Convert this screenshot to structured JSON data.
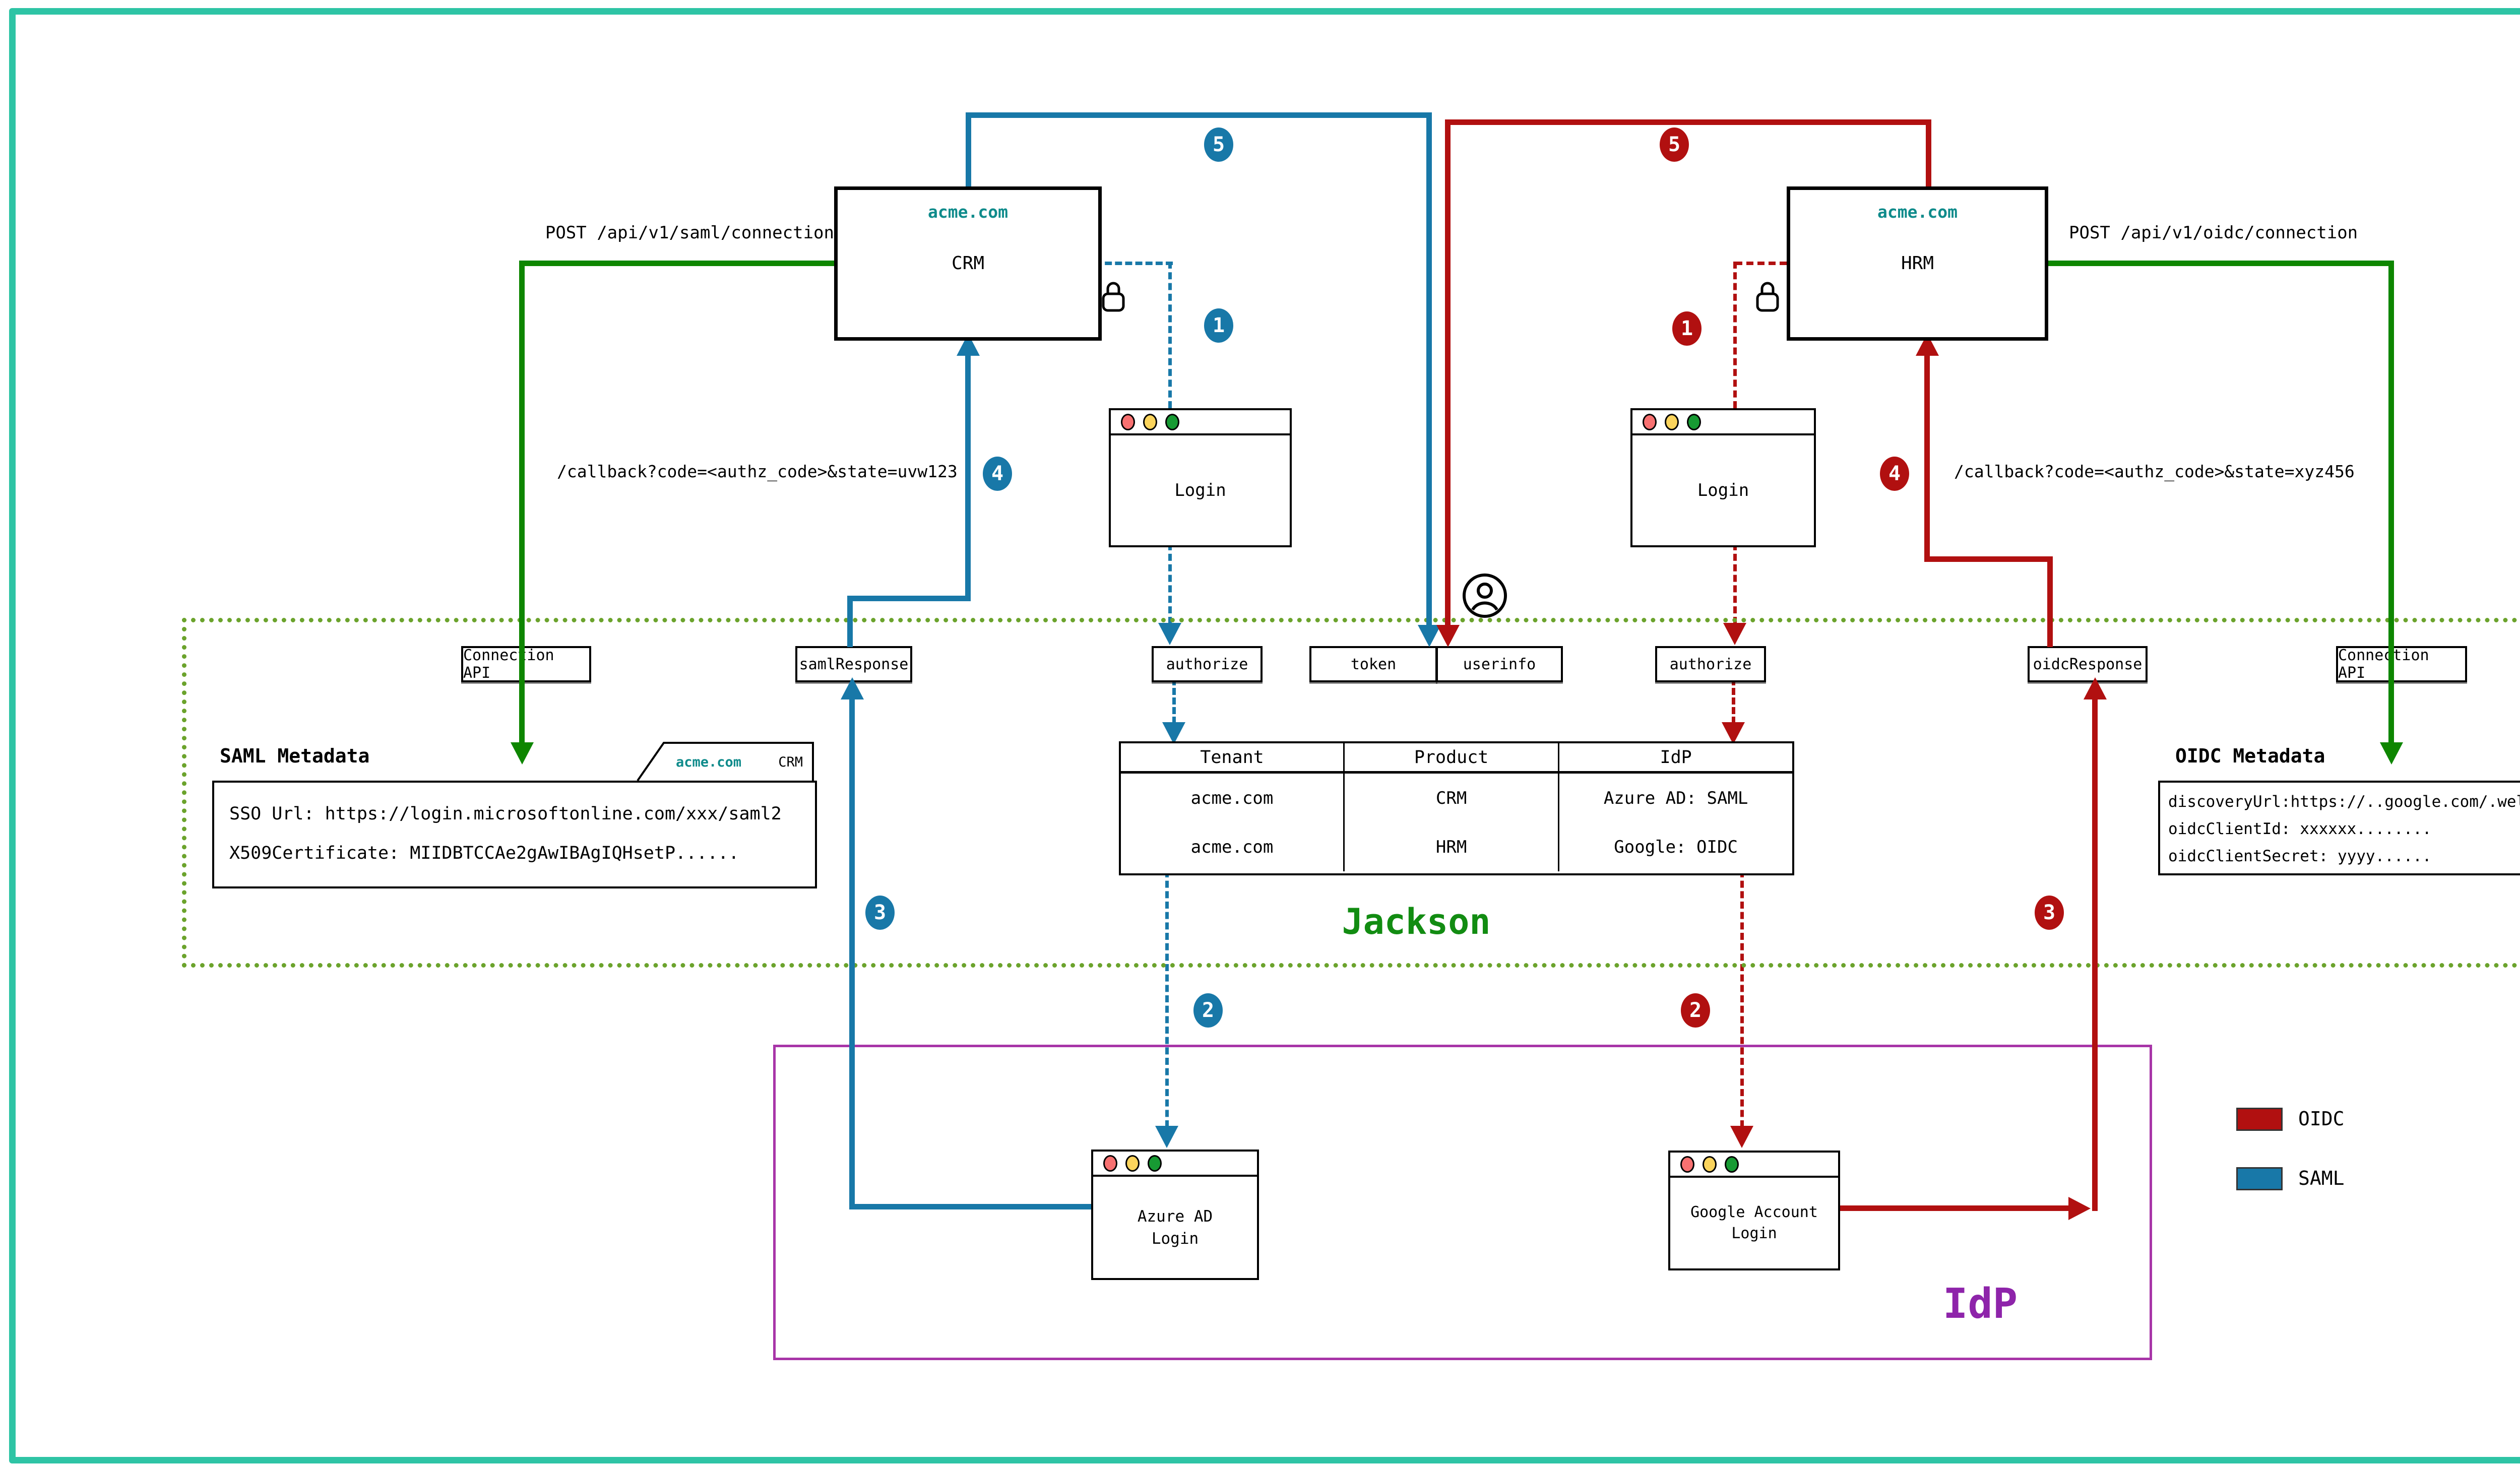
{
  "colors": {
    "saml_blue": "#1878a8",
    "oidc_red": "#b11010",
    "connection_green": "#0e8600",
    "jackson_green": "#128c12",
    "jackson_border_olive": "#6ba32c",
    "idp_purple": "#8e24aa",
    "domain_teal": "#0f8b8b",
    "frame_teal": "#2ec4a5"
  },
  "apps": {
    "crm": {
      "domain": "acme.com",
      "name": "CRM"
    },
    "hrm": {
      "domain": "acme.com",
      "name": "HRM"
    }
  },
  "flows": {
    "post_saml": "POST /api/v1/saml/connection",
    "post_oidc": "POST /api/v1/oidc/connection",
    "callback_saml": "/callback?code=<authz_code>&state=uvw123",
    "callback_oidc": "/callback?code=<authz_code>&state=xyz456"
  },
  "jackson": {
    "title": "Jackson",
    "ports": {
      "connection_api_left": "Connection API",
      "saml_response": "samlResponse",
      "authorize_left": "authorize",
      "token": "token",
      "userinfo": "userinfo",
      "authorize_right": "authorize",
      "oidc_response": "oidcResponse",
      "connection_api_right": "Connection API"
    }
  },
  "saml_metadata": {
    "title": "SAML Metadata",
    "tab_domain": "acme.com",
    "tab_product": "CRM",
    "line1": "SSO Url: https://login.microsoftonline.com/xxx/saml2",
    "line2": "X509Certificate: MIIDBTCCAe2gAwIBAgIQHsetP......"
  },
  "oidc_metadata": {
    "title": "OIDC Metadata",
    "tab_domain": "acme.com",
    "tab_product": "HRM",
    "line1": "discoveryUrl:https://..google.com/.well-known/openid-configuration",
    "line2": "oidcClientId: xxxxxx........",
    "line3": "oidcClientSecret: yyyy......"
  },
  "tenant_table": {
    "headers": [
      "Tenant",
      "Product",
      "IdP"
    ],
    "rows": [
      [
        "acme.com",
        "CRM",
        "Azure AD: SAML"
      ],
      [
        "acme.com",
        "HRM",
        "Google: OIDC"
      ]
    ]
  },
  "windows": {
    "login_left": "Login",
    "login_right": "Login",
    "azure_line1": "Azure AD",
    "azure_line2": "Login",
    "google_line1": "Google Account",
    "google_line2": "Login"
  },
  "idp": {
    "label": "IdP"
  },
  "legend": {
    "oidc": "OIDC",
    "saml": "SAML"
  },
  "steps": {
    "s1": "1",
    "s2": "2",
    "s3": "3",
    "s4": "4",
    "s5": "5"
  },
  "icons": {
    "lock": "lock-icon",
    "user": "user-icon",
    "window_controls": "traffic-lights-icon"
  }
}
